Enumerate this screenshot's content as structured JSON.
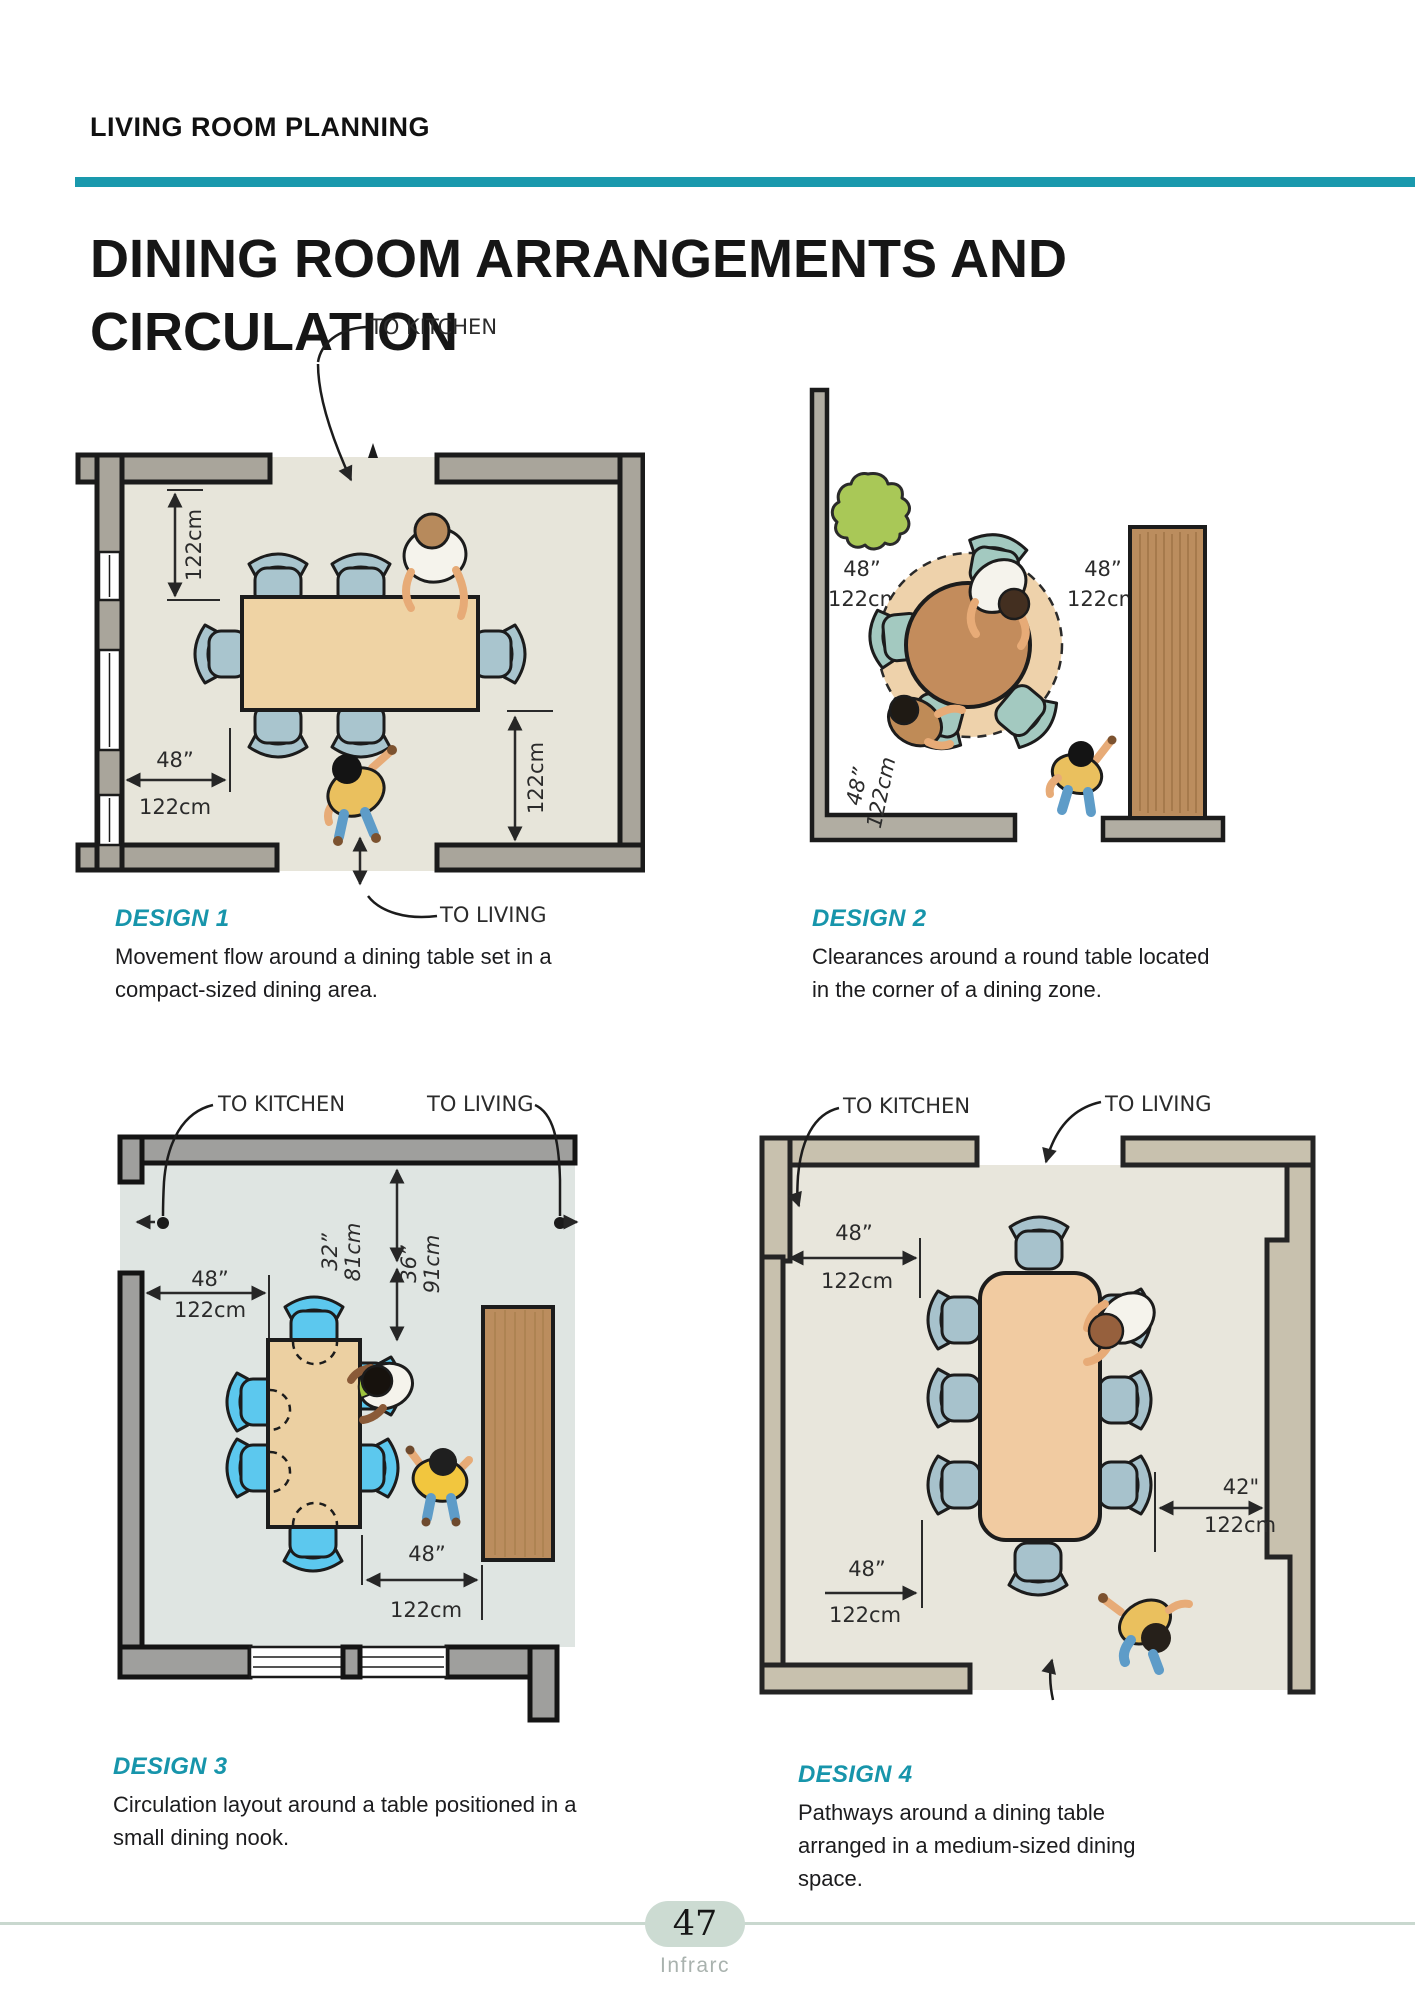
{
  "page": {
    "eyebrow": "LIVING ROOM PLANNING",
    "title_line1": "DINING ROOM ARRANGEMENTS AND",
    "title_line2": "CIRCULATION",
    "accent_color": "#1a99ad"
  },
  "designs": [
    {
      "name": "DESIGN 1",
      "caption": "Movement flow around a dining table set in a compact-sized dining area.",
      "to_kitchen": "TO KITCHEN",
      "to_living": "TO LIVING",
      "dim_left_v": "122cm",
      "dim_left_h_in": "48”",
      "dim_left_h_cm": "122cm",
      "dim_right_v": "122cm"
    },
    {
      "name": "DESIGN 2",
      "caption": "Clearances around a round table located in the corner of a dining zone.",
      "dim_wall_in": "48”",
      "dim_wall_cm": "122cm",
      "dim_cabinet_in": "48”",
      "dim_cabinet_cm": "122cm",
      "dim_corner_in": "48”",
      "dim_corner_cm": "122cm"
    },
    {
      "name": "DESIGN 3",
      "caption": "Circulation layout around a table positioned in a small dining nook.",
      "to_kitchen": "TO KITCHEN",
      "to_living": "TO LIVING",
      "dim_left_in": "48”",
      "dim_left_cm": "122cm",
      "dim_v1_in": "32”",
      "dim_v1_cm": "81cm",
      "dim_v2_in": "36”",
      "dim_v2_cm": "91cm",
      "dim_bottom_in": "48”",
      "dim_bottom_cm": "122cm"
    },
    {
      "name": "DESIGN 4",
      "caption": "Pathways around a dining table arranged in a medium-sized dining space.",
      "to_kitchen": "TO KITCHEN",
      "to_living": "TO LIVING",
      "dim_tl_in": "48”",
      "dim_tl_cm": "122cm",
      "dim_bl_in": "48”",
      "dim_bl_cm": "122cm",
      "dim_right_in": "42\"",
      "dim_right_cm": "122cm"
    }
  ],
  "footer": {
    "page_number": "47",
    "brand": "Infrarc"
  }
}
